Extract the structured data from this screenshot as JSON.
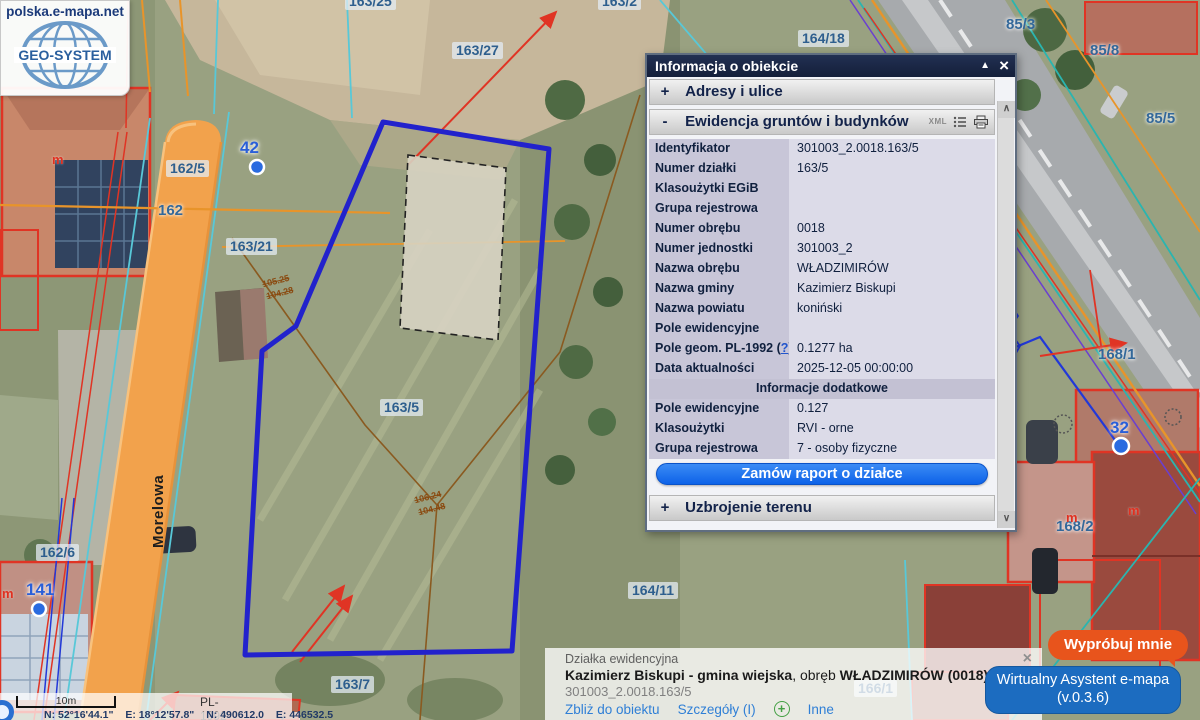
{
  "logo": {
    "site": "polska.e-mapa.net",
    "brand": "GEO-SYSTEM"
  },
  "icons": {
    "minimize": "▲",
    "close": "×",
    "scroll_up": "∧",
    "scroll_down": "∨",
    "dropdown": "∨",
    "plus": "+"
  },
  "panel": {
    "title": "Informacja o obiekcie",
    "sections": [
      {
        "prefix": "+",
        "label": "Adresy i ulice"
      },
      {
        "prefix": "-",
        "label": "Ewidencja gruntów i budynków",
        "xml": "XML"
      },
      {
        "prefix": "+",
        "label": "Uzbrojenie terenu"
      }
    ],
    "rows": [
      {
        "label": "Identyfikator",
        "value": "301003_2.0018.163/5"
      },
      {
        "label": "Numer działki",
        "value": "163/5"
      },
      {
        "label": "Klasoużytki EGiB",
        "value": ""
      },
      {
        "label": "Grupa rejestrowa",
        "value": ""
      },
      {
        "label": "Numer obrębu",
        "value": "0018"
      },
      {
        "label": "Numer jednostki",
        "value": "301003_2"
      },
      {
        "label": "Nazwa obrębu",
        "value": "WŁADZIMIRÓW"
      },
      {
        "label": "Nazwa gminy",
        "value": "Kazimierz Biskupi"
      },
      {
        "label": "Nazwa powiatu",
        "value": "koniński"
      },
      {
        "label": "Pole ewidencyjne",
        "value": ""
      },
      {
        "label": "Pole geom. PL-1992 (",
        "help": "?",
        "suffix": ")",
        "value": "0.1277 ha"
      },
      {
        "label": "Data aktualności",
        "value": "2025-12-05 00:00:00"
      }
    ],
    "subheader": "Informacje dodatkowe",
    "extra_rows": [
      {
        "label": "Pole ewidencyjne",
        "value": "0.127"
      },
      {
        "label": "Klasoużytki",
        "value": "RVI - orne"
      },
      {
        "label": "Grupa rejestrowa",
        "value": "7 - osoby fizyczne"
      }
    ],
    "order_button": "Zamów raport o działce"
  },
  "infobar": {
    "category": "Działka ewidencyjna",
    "name_bold1": "Kazimierz Biskupi - gmina wiejska",
    "name_mid": ", obręb ",
    "name_bold2": "WŁADZIMIRÓW (0018)",
    "name_tail": ", numer dz",
    "object_id": "301003_2.0018.163/5",
    "link_zoom": "Zbliż do obiektu",
    "link_details": "Szczegóły (I)",
    "link_other": "Inne"
  },
  "assistant": {
    "bubble": "Wypróbuj mnie",
    "title": "Wirtualny Asystent e-mapa",
    "version": "(v.0.3.6)"
  },
  "statusbar": {
    "scale_label": "10m",
    "crs": "PL-1992",
    "coord_lat": "N: 52°16'44.1\"",
    "coord_lon": "E: 18°12'57.8\"",
    "coord_n": "N: 490612.0",
    "coord_e": "E: 446532.5"
  },
  "map": {
    "labels": [
      {
        "text": "163/25"
      },
      {
        "text": "163/2"
      },
      {
        "text": "163/27"
      },
      {
        "text": "164/18"
      },
      {
        "text": "85/3"
      },
      {
        "text": "85/8"
      },
      {
        "text": "85/5"
      },
      {
        "text": "42"
      },
      {
        "text": "162/5"
      },
      {
        "text": "162"
      },
      {
        "text": "163/21"
      },
      {
        "text": "163/5"
      },
      {
        "text": "168/1"
      },
      {
        "text": "32"
      },
      {
        "text": "168/2"
      },
      {
        "text": "162/6"
      },
      {
        "text": "141"
      },
      {
        "text": "164/11"
      },
      {
        "text": "163/7"
      },
      {
        "text": "166/1"
      },
      {
        "text": "Morelowa"
      },
      {
        "text": "105.25"
      },
      {
        "text": "104.28"
      },
      {
        "text": "106.24"
      },
      {
        "text": "104.48"
      },
      {
        "text": "m"
      },
      {
        "text": "m"
      },
      {
        "text": "m"
      },
      {
        "text": "m"
      }
    ],
    "colors": {
      "selected_parcel": "#2222cc",
      "cadastral": "#58c8d8",
      "utility_red": "#e03424",
      "utility_orange": "#e8942a",
      "road_fill": "#f2a24c"
    }
  }
}
